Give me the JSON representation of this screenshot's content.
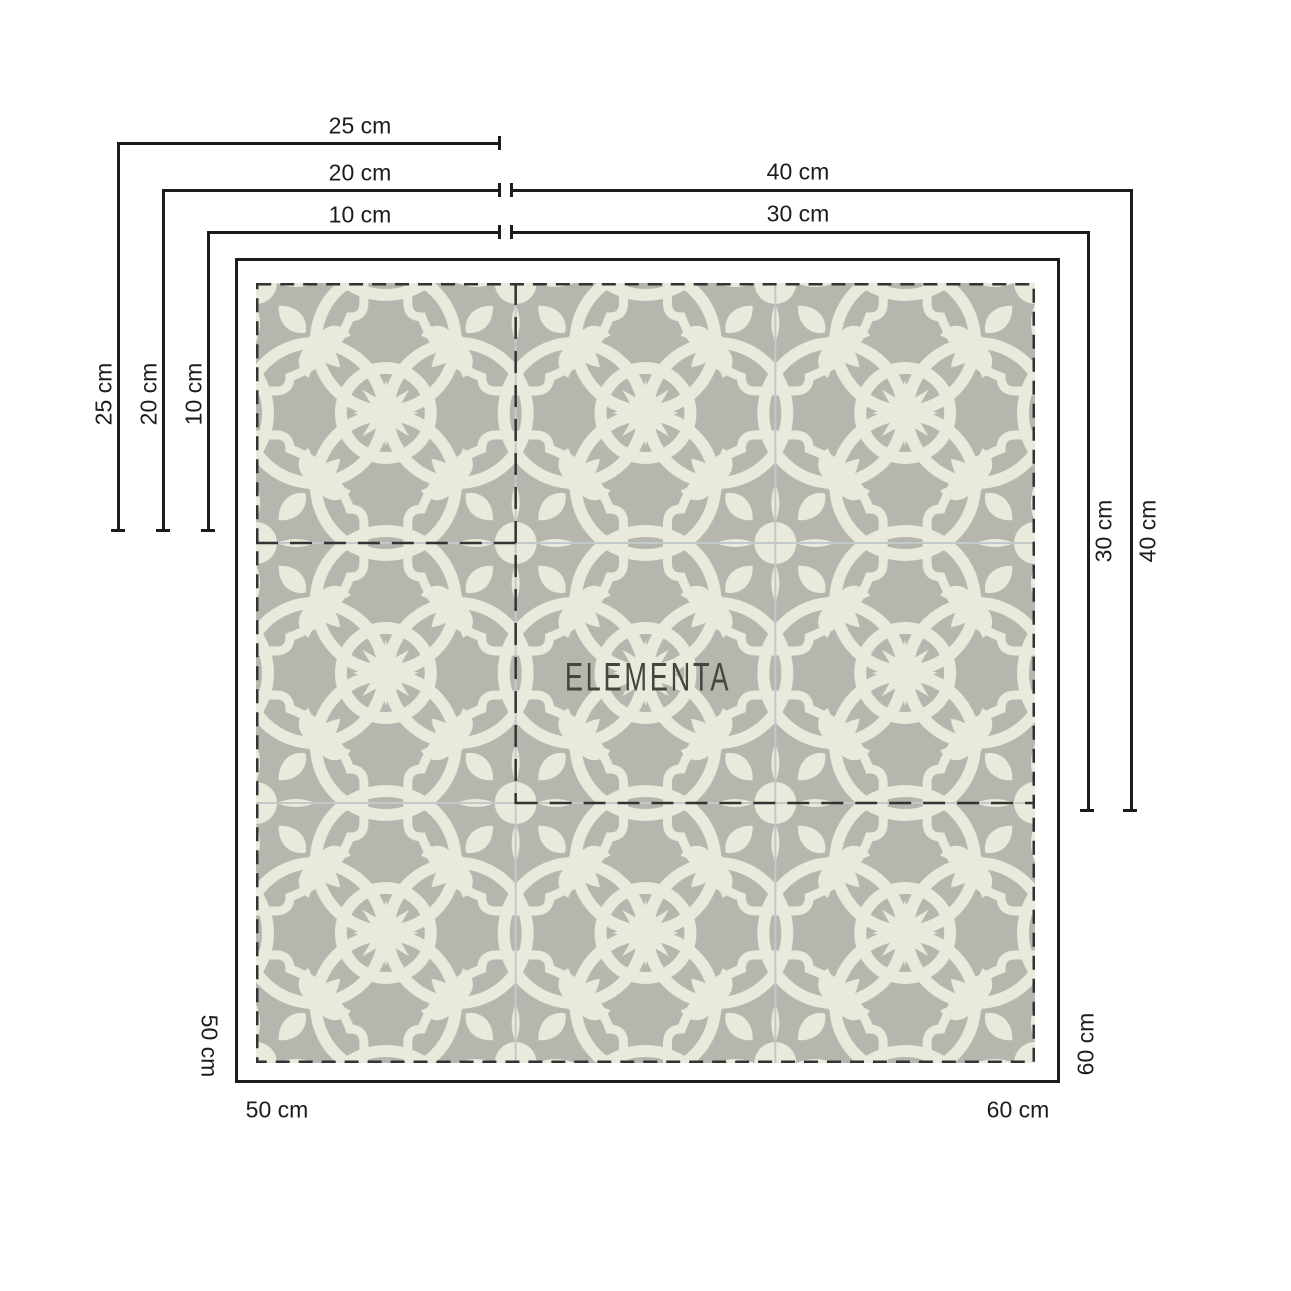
{
  "watermark": "ELEMENTA",
  "labels": {
    "top_25": "25 cm",
    "top_20": "20 cm",
    "top_10": "10 cm",
    "top_40": "40 cm",
    "top_30": "30 cm",
    "left_25": "25 cm",
    "left_20": "20 cm",
    "left_10": "10 cm",
    "right_30": "30 cm",
    "right_40": "40 cm",
    "bottom_v_50": "50 cm",
    "bottom_h_50": "50 cm",
    "bottom_v_60": "60 cm",
    "bottom_h_60": "60 cm"
  },
  "tile": {
    "grid": "3x3",
    "size_options_small_square": [
      "10 cm",
      "20 cm",
      "25 cm"
    ],
    "size_options_medium_square": [
      "30 cm",
      "40 cm"
    ],
    "size_options_large_square": [
      "50 cm",
      "60 cm"
    ],
    "colors": {
      "background": "#b6b6ae",
      "motif": "#e9e9dc",
      "grout": "#c3c8ca",
      "dimension_line": "#1c1c1c",
      "dashed_line": "#333333",
      "watermark_text": "#45453f"
    }
  }
}
